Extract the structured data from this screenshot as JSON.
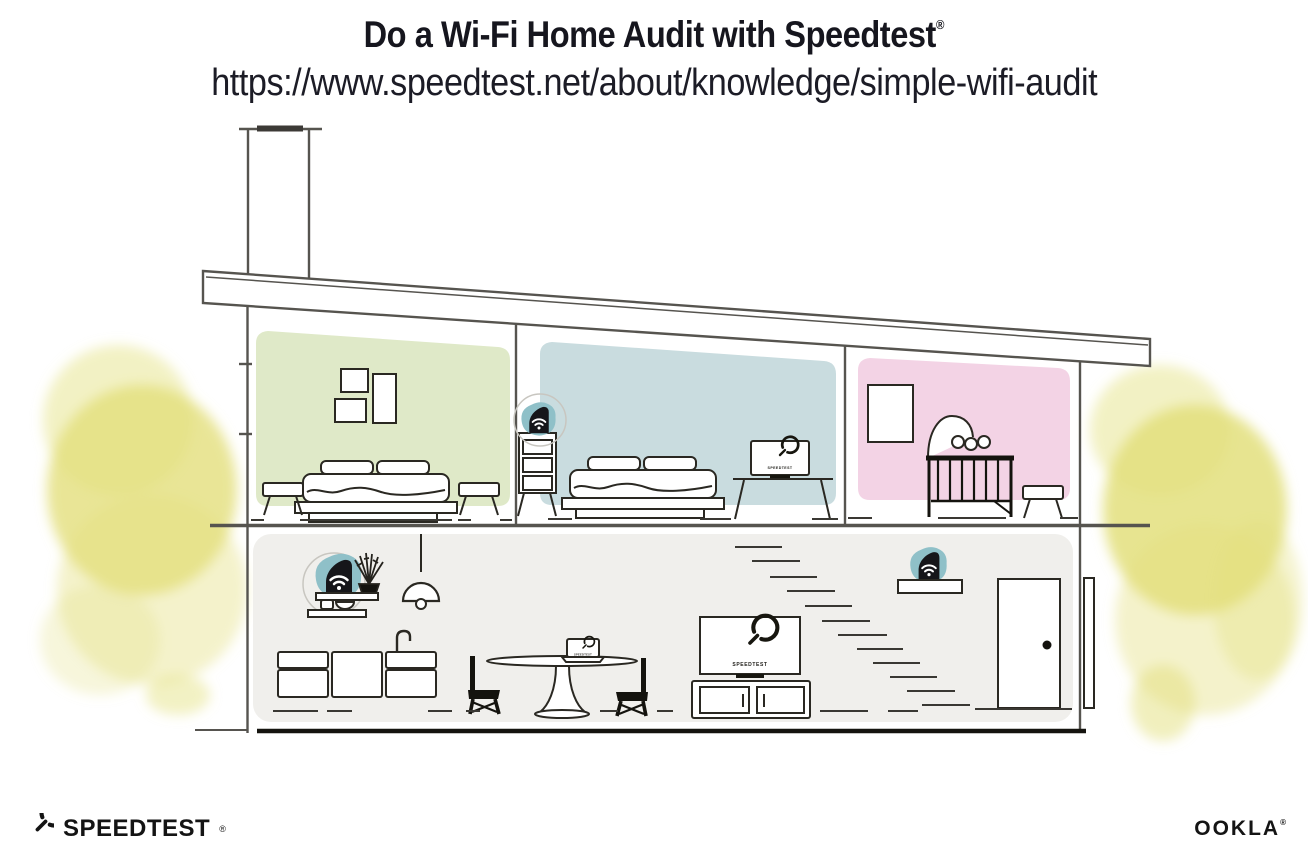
{
  "header": {
    "title": "Do a Wi-Fi Home Audit with Speedtest",
    "title_registered": "®",
    "url": "https://www.speedtest.net/about/knowledge/simple-wifi-audit"
  },
  "screens": {
    "bedroom_monitor_label": "SPEEDTEST",
    "living_room_tv_label": "SPEEDTEST",
    "dining_laptop_label": "SPEEDTEST"
  },
  "footer": {
    "speedtest_wordmark": "SPEEDTEST",
    "speedtest_registered": "®",
    "ookla_wordmark": "OOKLA",
    "ookla_registered": "®"
  },
  "icons": {
    "wifi_router": "wifi-router-icon",
    "speedtest_gauge": "speedtest-gauge-icon"
  },
  "colors": {
    "bedroom_green_wall": "#dfe9c8",
    "bedroom_blue_wall": "#c9dcdf",
    "nursery_pink_wall": "#f3d3e5",
    "downstairs_wall": "#f0efec",
    "router_highlight_teal": "#8fc0c8",
    "tree_yellow": "#e3df7c",
    "ink": "#1a1a20"
  }
}
